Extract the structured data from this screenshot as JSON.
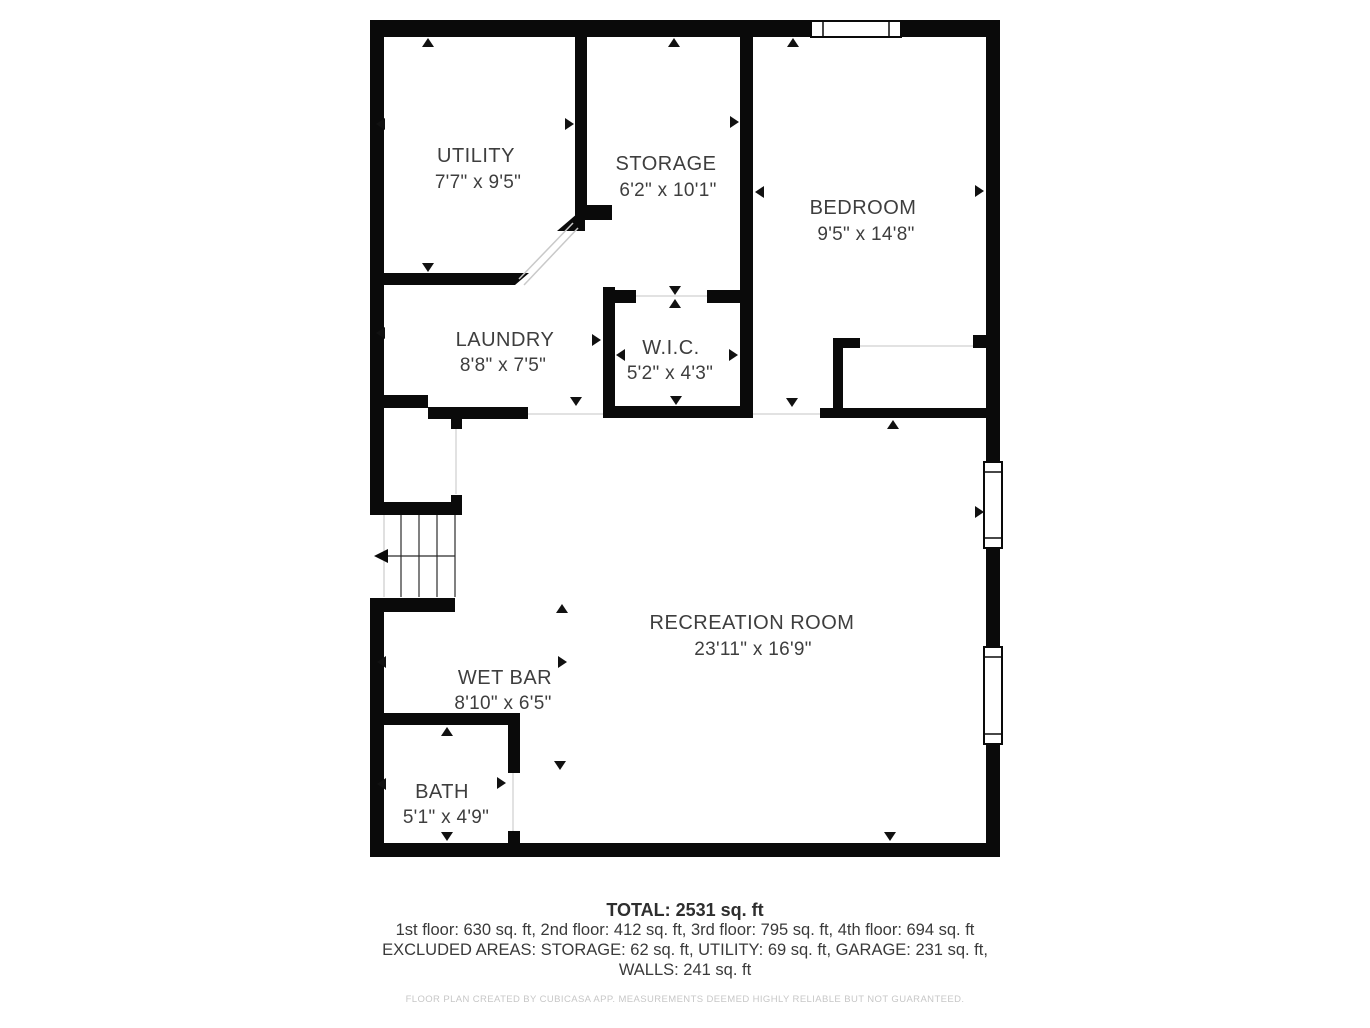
{
  "plan": {
    "rooms": [
      {
        "name": "UTILITY",
        "dims": "7'7\" x 9'5\""
      },
      {
        "name": "STORAGE",
        "dims": "6'2\" x 10'1\""
      },
      {
        "name": "BEDROOM",
        "dims": "9'5\" x 14'8\""
      },
      {
        "name": "LAUNDRY",
        "dims": "8'8\" x 7'5\""
      },
      {
        "name": "W.I.C.",
        "dims": "5'2\" x 4'3\""
      },
      {
        "name": "RECREATION ROOM",
        "dims": "23'11\" x 16'9\""
      },
      {
        "name": "WET BAR",
        "dims": "8'10\" x 6'5\""
      },
      {
        "name": "BATH",
        "dims": "5'1\" x 4'9\""
      }
    ],
    "features": {
      "stairs": "staircase with down-direction arrow",
      "windows": [
        "top wall window",
        "right wall upper window",
        "right wall lower window"
      ],
      "doors": [
        "diagonal swing door utility-storage corridor",
        "laundry opening",
        "storage-wic opening",
        "bedroom opening",
        "bath door",
        "stair landing door"
      ]
    }
  },
  "summary": {
    "total": "TOTAL: 2531 sq. ft",
    "floors": "1st floor: 630 sq. ft, 2nd floor: 412 sq. ft, 3rd floor: 795 sq. ft, 4th floor: 694 sq. ft",
    "excluded": "EXCLUDED AREAS: STORAGE: 62 sq. ft, UTILITY: 69 sq. ft, GARAGE: 231 sq. ft,",
    "walls": "WALLS: 241 sq. ft",
    "disclaimer": "FLOOR PLAN CREATED BY CUBICASA APP. MEASUREMENTS DEEMED HIGHLY RELIABLE BUT NOT GUARANTEED."
  },
  "colors": {
    "wall": "#0a0a0a",
    "room_text": "#3e3e3e",
    "muted_text": "#c7c7c7",
    "thin_line": "#d8d8d8"
  }
}
